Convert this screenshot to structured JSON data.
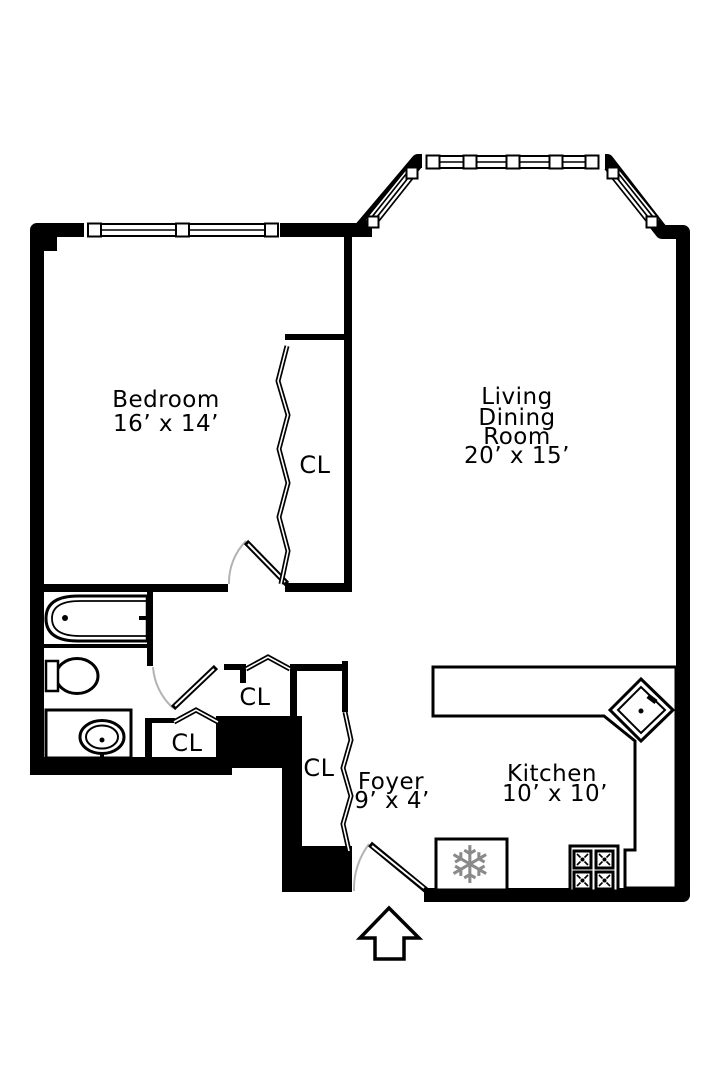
{
  "plan_title": "One-bedroom apartment floor plan",
  "rooms": {
    "bedroom": {
      "name": "Bedroom",
      "dims": "16’ x 14’"
    },
    "living_dining": {
      "line1": "Living",
      "line2": "Dining",
      "line3": "Room",
      "dims": "20’ x 15’"
    },
    "kitchen": {
      "name": "Kitchen",
      "dims": "10’ x 10’"
    },
    "foyer": {
      "name": "Foyer",
      "dims": "9’ x 4’"
    }
  },
  "closets": {
    "bedroom_closet_label": "CL",
    "hall_closet_upper_label": "CL",
    "hall_closet_lower_label": "CL",
    "foyer_closet_label": "CL"
  },
  "icons": {
    "refrigerator_snowflake": "❄"
  },
  "colors": {
    "walls": "#000000",
    "background": "#ffffff",
    "door_swing_arc": "#b3b3b3",
    "appliance_icon_gray": "#8a8a8a"
  }
}
